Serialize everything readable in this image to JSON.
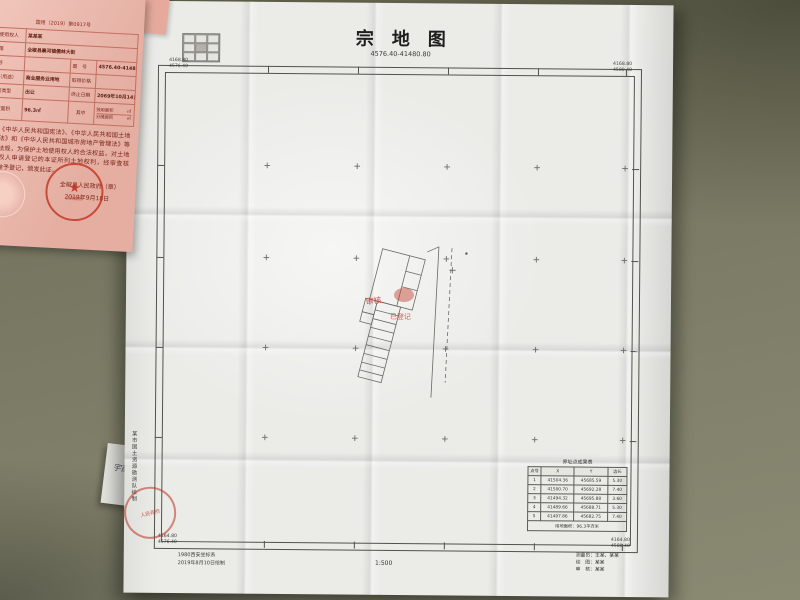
{
  "colors": {
    "desk": "#72725e",
    "paper": "#ebebe8",
    "certificate_pink": "#eeb5a8",
    "certificate_text": "#7c241a",
    "seal_red": "#c23b2b",
    "map_line": "#52524c"
  },
  "certificate": {
    "doc_no": "国用（2019）第0917号",
    "rows": [
      {
        "label": "土地使用权人",
        "value": "某某某"
      },
      {
        "label": "坐　落",
        "value": "全椒县襄河镇儒林大街"
      },
      {
        "label": "地　号",
        "value": "",
        "label2": "图　号",
        "value2": "4576.40-41480.80"
      },
      {
        "label": "地类（用途）",
        "value": "商业服务业用地",
        "label2": "取得价格",
        "value2": ""
      },
      {
        "label": "使用权类型",
        "value": "出让",
        "label2": "终止日期",
        "value2": "2069年10月14日"
      },
      {
        "label": "使用权面积",
        "value": "96.3㎡",
        "mid": "其中",
        "sub1_label": "独用面积",
        "sub1_unit": "㎡",
        "sub2_label": "分摊面积",
        "sub2_unit": "㎡"
      }
    ],
    "statement": "根据《中华人民共和国宪法》、《中华人民共和国土地管理法》和《中华人民共和国城市房地产管理法》等法律法规，为保护土地使用权人的合法权益，对土地使用权人申请登记的本证所列土地权利，经审查核实，准予登记，颁发此证。",
    "issuer": "全椒县人民政府（章）",
    "issue_date": "2019年9月18日",
    "seal_text": "人民政府"
  },
  "map": {
    "title": "宗　地　图",
    "subtitle": "4576.40-41480.80",
    "corners": {
      "tl": [
        "4168.80",
        "4576.40"
      ],
      "tr": [
        "4168.80",
        "4580.40"
      ],
      "bl": [
        "4164.80",
        "4576.40"
      ],
      "br": [
        "4164.80",
        "4580.40"
      ]
    },
    "btable": {
      "title": "界址点成果表",
      "headers": [
        "点号",
        "X",
        "Y",
        "边长"
      ],
      "rows": [
        [
          "1",
          "41504.36",
          "45685.59",
          "5.30"
        ],
        [
          "2",
          "41500.70",
          "45692.28",
          "7.40"
        ],
        [
          "3",
          "41494.32",
          "45695.88",
          "3.60"
        ],
        [
          "4",
          "41489.66",
          "45688.71",
          "5.30"
        ],
        [
          "5",
          "41497.86",
          "45682.75",
          "7.40"
        ]
      ],
      "footer": "用地面积：96.3平方米"
    },
    "notes": [
      "1980西安坐标系",
      "2019年8月10日绘制"
    ],
    "scale": "1:500",
    "credits": [
      "测量员：王某、某某",
      "绘　图：某某",
      "审　核：某某"
    ],
    "side_text": "某市国土资源勘测队绘制",
    "stamps": [
      "审核",
      "已登记"
    ],
    "handwriting": "宇亩"
  }
}
